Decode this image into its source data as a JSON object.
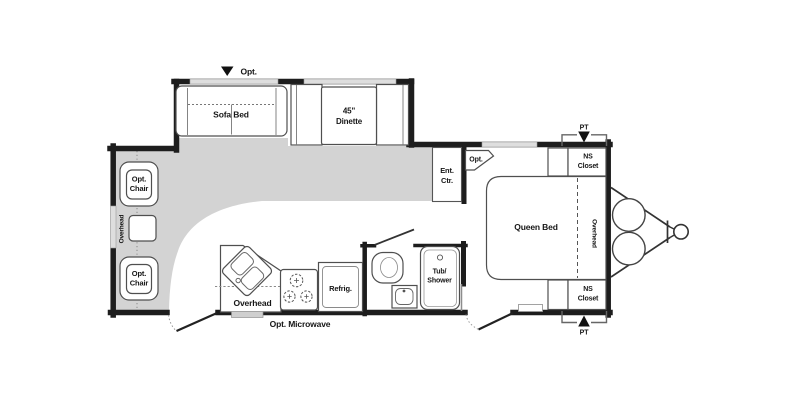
{
  "floorplan": {
    "colors": {
      "wall": "#1d1d1d",
      "floor_shade": "#d3d3d3",
      "furniture_outline": "#4f4f4f",
      "label_text": "#161616",
      "background": "#ffffff"
    },
    "slideout": {
      "opt_marker": "Opt.",
      "sofa_bed": "Sofa Bed",
      "dinette_size": "45\"",
      "dinette_label": "Dinette"
    },
    "front_lounge": {
      "chair_upper_line1": "Opt.",
      "chair_upper_line2": "Chair",
      "chair_lower_line1": "Opt.",
      "chair_lower_line2": "Chair",
      "overhead": "Overhead"
    },
    "kitchen": {
      "overhead": "Overhead",
      "opt_microwave": "Opt. Microwave",
      "refrigerator": "Refrig."
    },
    "bathroom": {
      "tub_line1": "Tub/",
      "tub_line2": "Shower"
    },
    "living": {
      "ent_center_line1": "Ent.",
      "ent_center_line2": "Ctr.",
      "opt_tv": "Opt."
    },
    "bedroom": {
      "queen_bed": "Queen Bed",
      "overhead": "Overhead",
      "ns_closet_top_line1": "NS",
      "ns_closet_top_line2": "Closet",
      "ns_closet_bottom_line1": "NS",
      "ns_closet_bottom_line2": "Closet"
    },
    "exterior": {
      "pt_top": "PT",
      "pt_bottom": "PT"
    }
  }
}
